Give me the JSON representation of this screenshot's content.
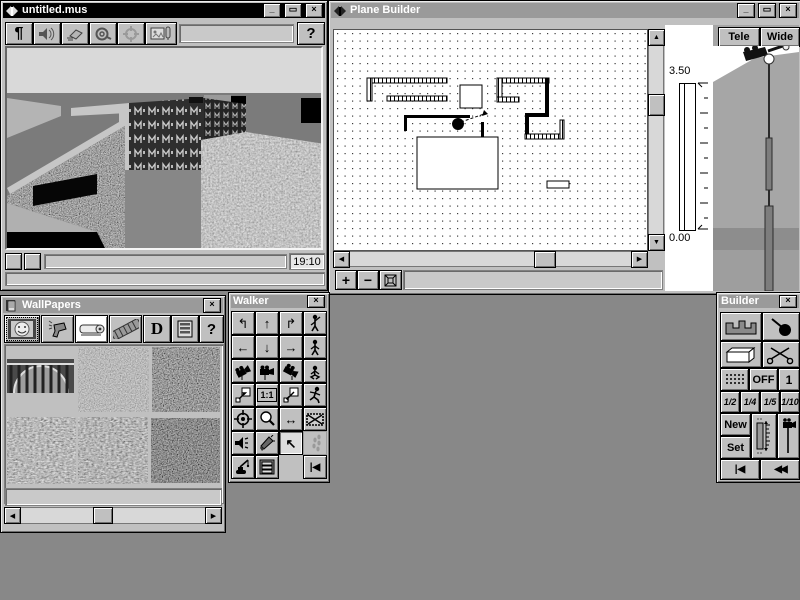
{
  "desktop": {
    "bg": "#888888"
  },
  "glyph_bank": {
    "minimize": "_",
    "maximize": "▭",
    "close": "×",
    "up": "▲",
    "down": "▼",
    "left": "◀",
    "right": "▶"
  },
  "viewer": {
    "title": "untitled.mus",
    "toolbar": {
      "pilcrow": "¶",
      "help": "?"
    },
    "status": {
      "time": "19:10"
    }
  },
  "plane": {
    "title": "Plane Builder",
    "lens": {
      "tele": "Tele",
      "wide": "Wide"
    },
    "scale": {
      "max": "3.50",
      "min": "0.00"
    },
    "tools": {
      "zoom_in": "+",
      "zoom_out": "−"
    }
  },
  "wallpapers": {
    "title": "WallPapers",
    "toolbar": {
      "letter_d": "D",
      "help": "?"
    }
  },
  "walker": {
    "title": "Walker",
    "glyphs": {
      "turn_left": "↰",
      "forward": "↑",
      "turn_right": "↱",
      "left": "←",
      "back": "↓",
      "right": "→",
      "one_to_one": "1:1",
      "pan": "↔",
      "cursor": "↖",
      "first": "|◀"
    }
  },
  "builder": {
    "title": "Builder",
    "labels": {
      "off": "OFF",
      "one": "1",
      "new": "New",
      "set": "Set",
      "first": "|◀",
      "rewind": "◀◀"
    },
    "fractions": [
      "1/2",
      "1/4",
      "1/5",
      "1/10"
    ]
  },
  "plan_data": {
    "type": "floorplan",
    "camera": {
      "x": 124,
      "y": 94,
      "arrow_to_x": 150,
      "arrow_to_y": 84
    },
    "walls": [
      {
        "kind": "hatched",
        "x": 33,
        "y": 48,
        "w": 80,
        "h": 5
      },
      {
        "kind": "hatched",
        "x": 33,
        "y": 48,
        "w": 5,
        "h": 23
      },
      {
        "kind": "hatched",
        "x": 53,
        "y": 66,
        "w": 60,
        "h": 5
      },
      {
        "kind": "hatched",
        "x": 163,
        "y": 48,
        "w": 52,
        "h": 5
      },
      {
        "kind": "hatched",
        "x": 163,
        "y": 48,
        "w": 5,
        "h": 23
      },
      {
        "kind": "hatched",
        "x": 163,
        "y": 67,
        "w": 22,
        "h": 5
      },
      {
        "kind": "solid",
        "x": 211,
        "y": 48,
        "w": 4,
        "h": 39
      },
      {
        "kind": "solid",
        "x": 191,
        "y": 83,
        "w": 24,
        "h": 4
      },
      {
        "kind": "solid",
        "x": 191,
        "y": 83,
        "w": 4,
        "h": 25
      },
      {
        "kind": "hatched",
        "x": 191,
        "y": 104,
        "w": 39,
        "h": 5
      },
      {
        "kind": "hatched",
        "x": 226,
        "y": 90,
        "w": 4,
        "h": 19
      },
      {
        "kind": "solid",
        "x": 70,
        "y": 85,
        "w": 66,
        "h": 3
      },
      {
        "kind": "solid",
        "x": 70,
        "y": 85,
        "w": 3,
        "h": 16
      },
      {
        "kind": "solid",
        "x": 147,
        "y": 92,
        "w": 3,
        "h": 16
      },
      {
        "kind": "outline",
        "x": 83,
        "y": 107,
        "w": 81,
        "h": 52
      },
      {
        "kind": "outline",
        "x": 126,
        "y": 55,
        "w": 22,
        "h": 23
      },
      {
        "kind": "outline",
        "x": 213,
        "y": 151,
        "w": 22,
        "h": 7
      }
    ]
  }
}
